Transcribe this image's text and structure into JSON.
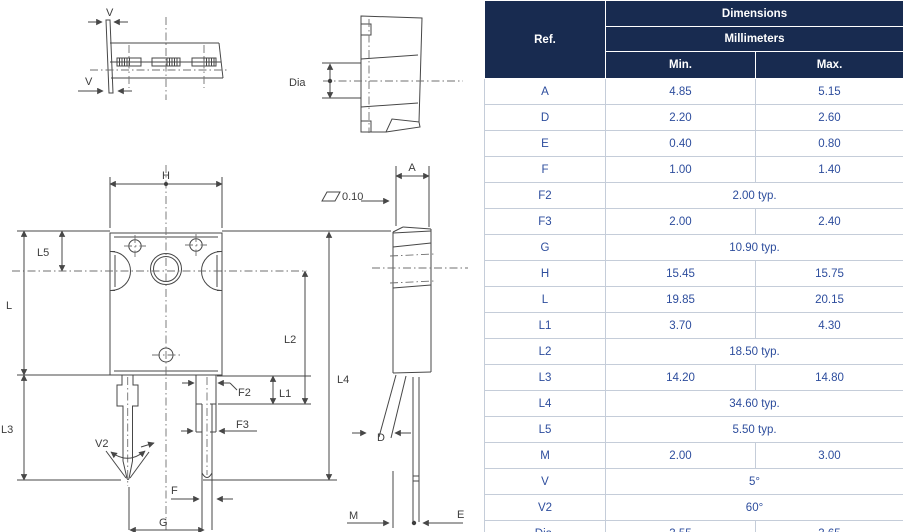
{
  "colors": {
    "header_bg": "#182b50",
    "header_text": "#ffffff",
    "body_text": "#2d4d9d",
    "table_border": "#c5cdd9",
    "drawing_line": "#474747"
  },
  "table": {
    "header": {
      "ref": "Ref.",
      "dimensions": "Dimensions",
      "millimeters": "Millimeters",
      "min": "Min.",
      "max": "Max."
    },
    "rows": [
      {
        "ref": "A",
        "min": "4.85",
        "max": "5.15"
      },
      {
        "ref": "D",
        "min": "2.20",
        "max": "2.60"
      },
      {
        "ref": "E",
        "min": "0.40",
        "max": "0.80"
      },
      {
        "ref": "F",
        "min": "1.00",
        "max": "1.40"
      },
      {
        "ref": "F2",
        "span": "2.00 typ."
      },
      {
        "ref": "F3",
        "min": "2.00",
        "max": "2.40"
      },
      {
        "ref": "G",
        "span": "10.90 typ."
      },
      {
        "ref": "H",
        "min": "15.45",
        "max": "15.75"
      },
      {
        "ref": "L",
        "min": "19.85",
        "max": "20.15"
      },
      {
        "ref": "L1",
        "min": "3.70",
        "max": "4.30"
      },
      {
        "ref": "L2",
        "span": "18.50 typ."
      },
      {
        "ref": "L3",
        "min": "14.20",
        "max": "14.80"
      },
      {
        "ref": "L4",
        "span": "34.60 typ."
      },
      {
        "ref": "L5",
        "span": "5.50 typ."
      },
      {
        "ref": "M",
        "min": "2.00",
        "max": "3.00"
      },
      {
        "ref": "V",
        "span": "5°"
      },
      {
        "ref": "V2",
        "span": "60°"
      },
      {
        "ref": "Dia.",
        "min": "3.55",
        "max": "3.65"
      }
    ]
  },
  "drawing": {
    "labels": {
      "v_top": "V",
      "v_bottom": "V",
      "dia": "Dia",
      "h": "H",
      "l5": "L5",
      "l": "L",
      "l3": "L3",
      "v2": "V2",
      "f2": "F2",
      "f3": "F3",
      "f": "F",
      "g": "G",
      "l1": "L1",
      "l2": "L2",
      "a": "A",
      "flatness": "0.10",
      "l4": "L4",
      "d": "D",
      "m": "M",
      "e": "E"
    }
  }
}
